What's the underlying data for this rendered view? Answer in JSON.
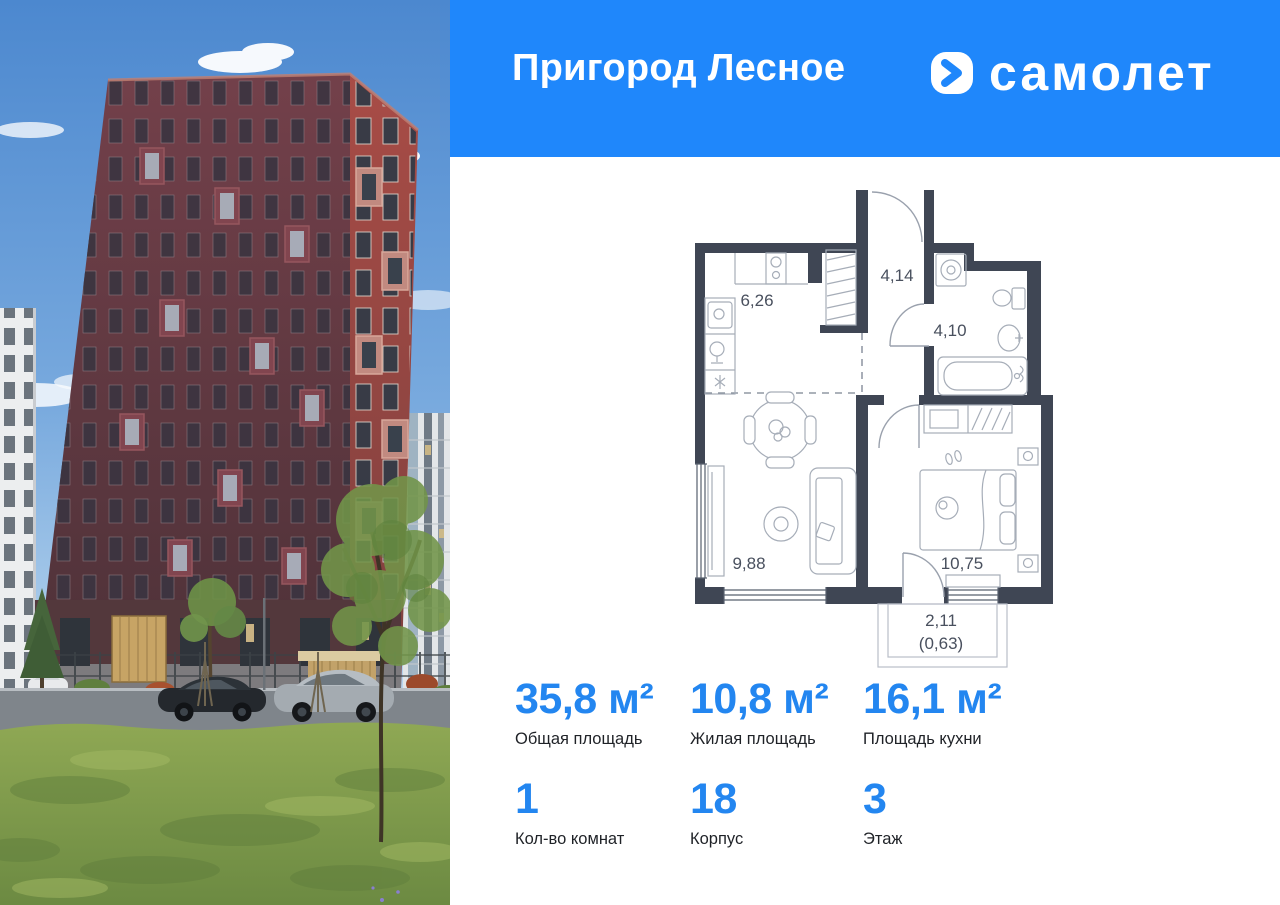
{
  "header": {
    "project_title": "Пригород Лесное",
    "brand": "самолет",
    "bg_color": "#1f87fb"
  },
  "floor_plan": {
    "wall_color": "#3f4654",
    "rooms": [
      {
        "id": "kitchen",
        "area": "6,26"
      },
      {
        "id": "hallway",
        "area": "4,14"
      },
      {
        "id": "bathroom",
        "area": "4,10"
      },
      {
        "id": "living-room",
        "area": "9,88"
      },
      {
        "id": "bedroom",
        "area": "10,75"
      },
      {
        "id": "balcony",
        "area": "2,11",
        "area_weighted": "(0,63)"
      }
    ]
  },
  "stats": {
    "accent_color": "#2386f0",
    "items": [
      {
        "value": "35,8",
        "unit": " м²",
        "label": "Общая площадь"
      },
      {
        "value": "10,8",
        "unit": " м²",
        "label": "Жилая площадь"
      },
      {
        "value": "16,1",
        "unit": " м²",
        "label": "Площадь кухни"
      },
      {
        "value": "1",
        "unit": "",
        "label": "Кол-во комнат"
      },
      {
        "value": "18",
        "unit": "",
        "label": "Корпус"
      },
      {
        "value": "3",
        "unit": "",
        "label": "Этаж"
      }
    ]
  }
}
